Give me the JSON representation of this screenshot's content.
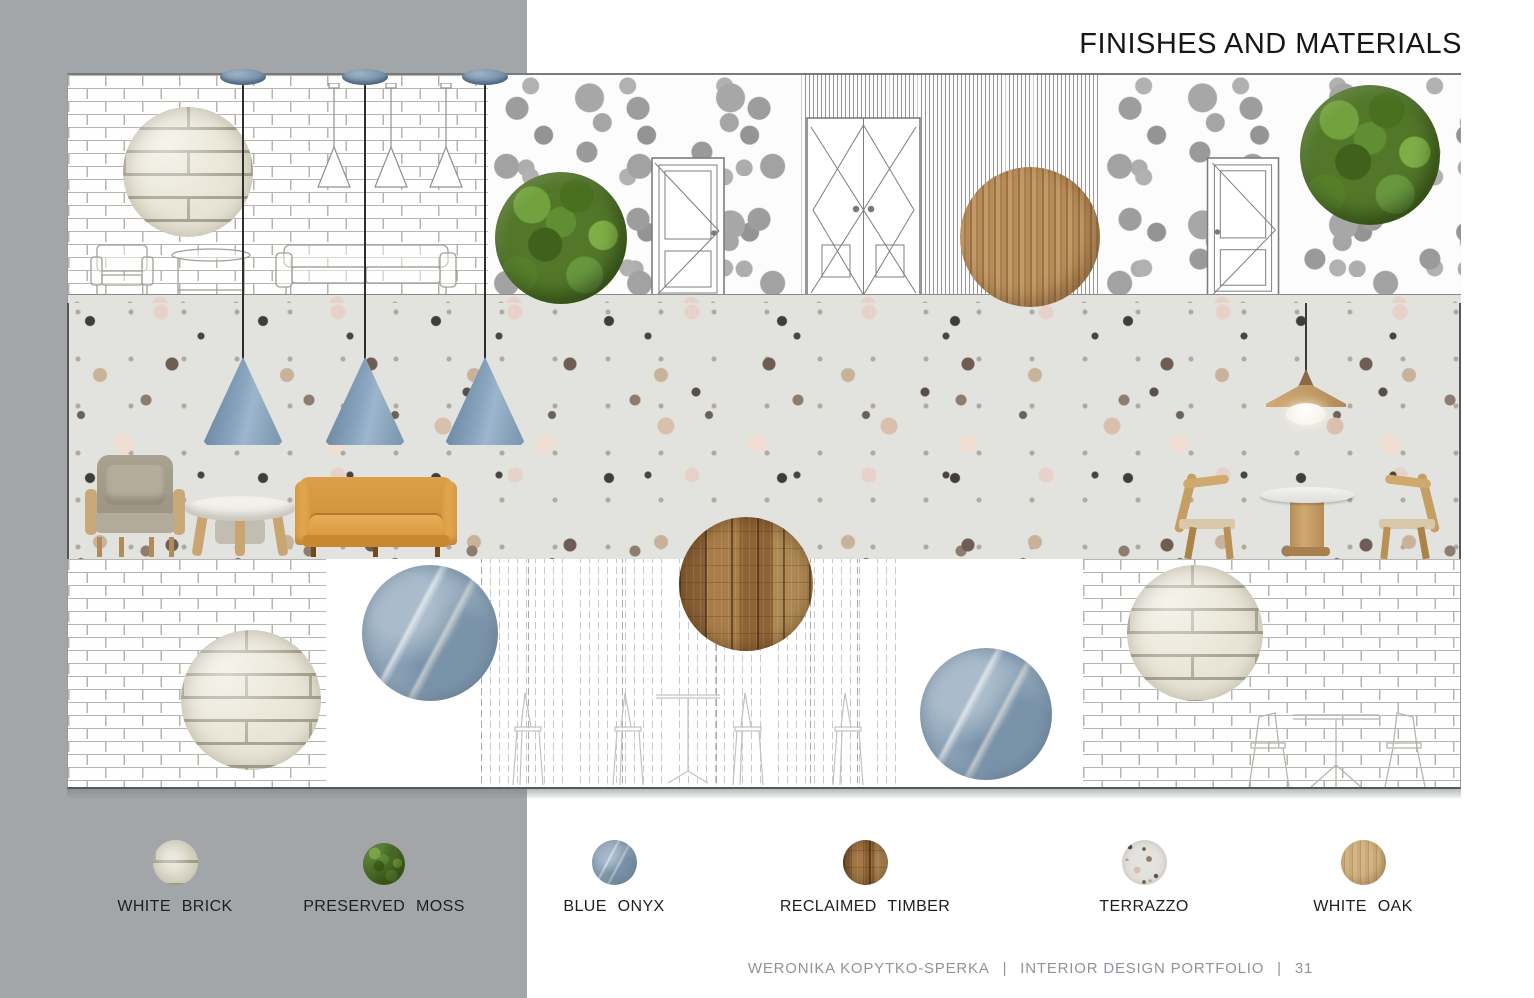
{
  "title": "FINISHES AND MATERIALS",
  "legend": {
    "items": [
      {
        "name": "white-brick",
        "label": "WHITE BRICK",
        "color": "#e9e5d6"
      },
      {
        "name": "preserved-moss",
        "label": "PRESERVED MOSS",
        "color": "#567c2b"
      },
      {
        "name": "blue-onyx",
        "label": "BLUE ONYX",
        "color": "#93a9bd"
      },
      {
        "name": "reclaimed-timber",
        "label": "RECLAIMED TIMBER",
        "color": "#9a7040"
      },
      {
        "name": "terrazzo",
        "label": "TERRAZZO",
        "color": "#e4e2df"
      },
      {
        "name": "white-oak",
        "label": "WHITE OAK",
        "color": "#c5a677"
      }
    ]
  },
  "footer": {
    "author": "WERONIKA KOPYTKO-SPERKA",
    "separator": "|",
    "portfolio": "INTERIOR DESIGN PORTFOLIO",
    "page_number": "31"
  },
  "colors": {
    "side_panel_gray": "#a2a6a9",
    "pendant_blue": "#84a0ba",
    "sofa_camel": "#d6973f",
    "terrazzo_base": "#e2e2de",
    "title_text": "#161616",
    "footer_text": "#8e9499"
  }
}
